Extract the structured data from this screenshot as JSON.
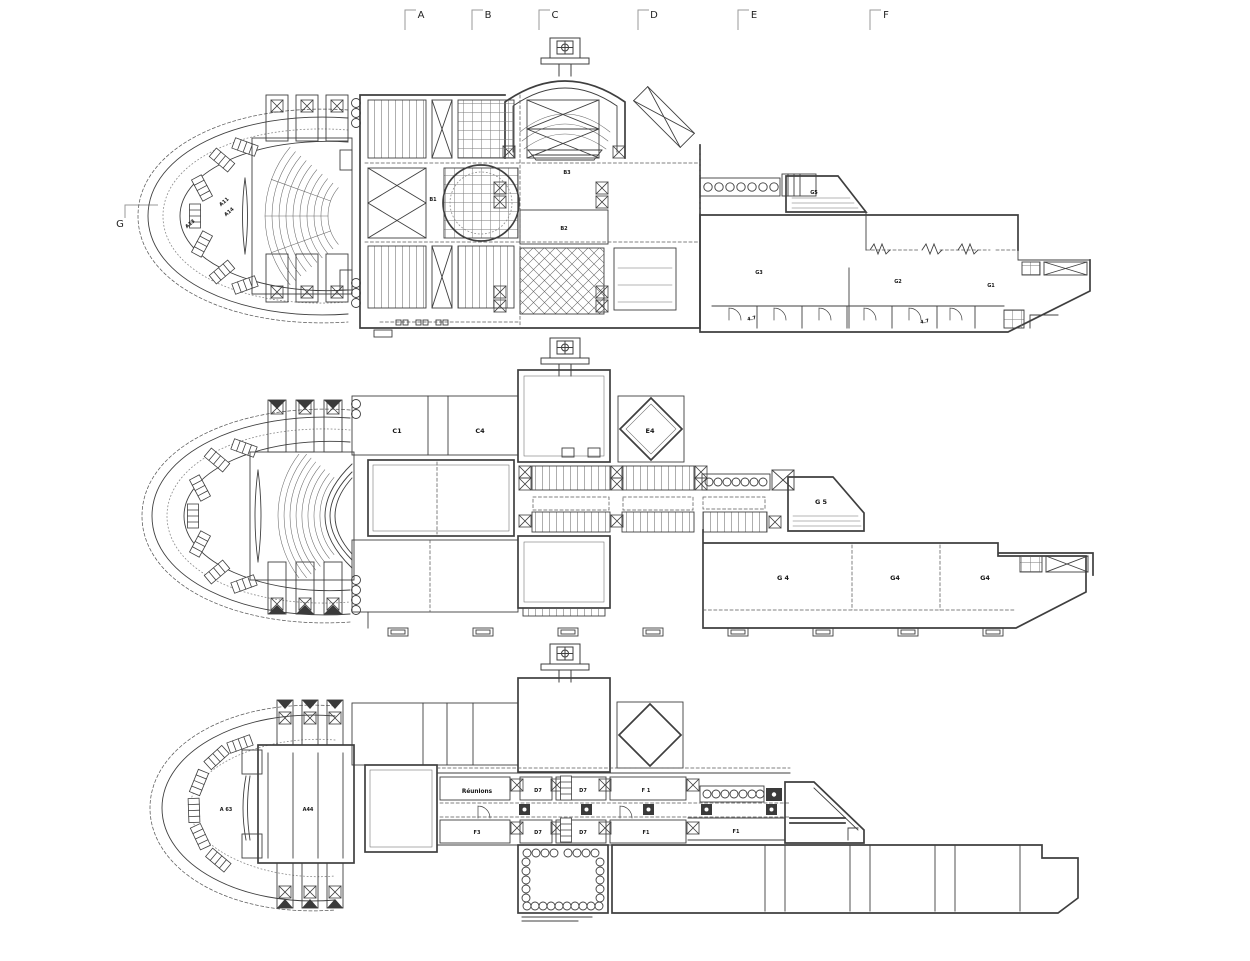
{
  "drawing": {
    "kind": "architectural floor plans, three levels, scanned line drawing",
    "colors": {
      "background": "#ffffff",
      "wall_line": "#3f3f3f",
      "marker_line": "#9a9a9a",
      "label_text": "#161616"
    }
  },
  "section_markers": {
    "top": [
      {
        "label": "A"
      },
      {
        "label": "B"
      },
      {
        "label": "C"
      },
      {
        "label": "D"
      },
      {
        "label": "E"
      },
      {
        "label": "F"
      }
    ],
    "left": {
      "label": "G"
    }
  },
  "plans": {
    "top": {
      "labels": {
        "a11": "A11",
        "a14": "A14",
        "a13": "A13",
        "b1": "B1",
        "b3": "B3",
        "b2": "B2",
        "g5": "G5",
        "g3": "G3",
        "g2": "G2",
        "g1": "G1",
        "d47a": "4.7",
        "d47b": "4.7"
      }
    },
    "middle": {
      "labels": {
        "c1": "C1",
        "c4": "C4",
        "e4": "E4",
        "g5": "G 5",
        "g4a": "G 4",
        "g4b": "G4",
        "g4c": "G4"
      }
    },
    "bottom": {
      "labels": {
        "a63": "A 63",
        "a44": "A44",
        "reunions": "Réunions",
        "d7a": "D7",
        "d7b": "D7",
        "d7c": "D7",
        "d7d": "D7",
        "f1a": "F 1",
        "f1b": "F1",
        "f1c": "F1",
        "f3": "F3"
      }
    }
  }
}
